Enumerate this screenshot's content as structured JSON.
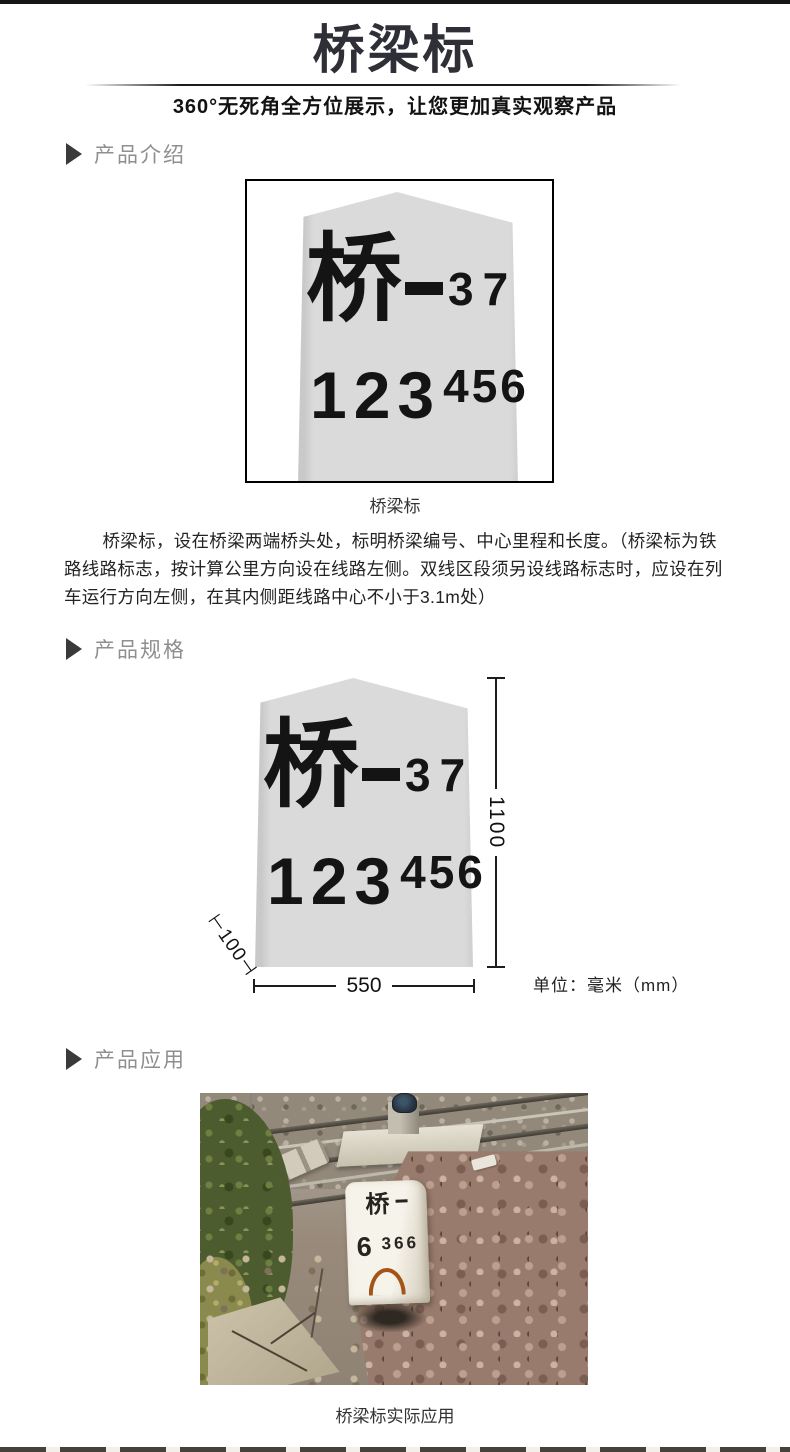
{
  "page": {
    "title": "桥梁标",
    "subtitle": "360°无死角全方位展示，让您更加真实观察产品"
  },
  "sections": {
    "intro_label": "产品介绍",
    "spec_label": "产品规格",
    "application_label": "产品应用"
  },
  "marker": {
    "char": "桥",
    "dash": "—",
    "number_top": "37",
    "number_main": "123",
    "number_sup": "456"
  },
  "figure1": {
    "caption": "桥梁标"
  },
  "intro_text": "桥梁标，设在桥梁两端桥头处，标明桥梁编号、中心里程和长度。（桥梁标为铁路线路标志，按计算公里方向设在线路左侧。双线区段须另设线路标志时，应设在列车运行方向左侧，在其内侧距线路中心不小于3.1m处）",
  "spec": {
    "height_label": "1100",
    "width_label": "550",
    "depth_label": "⊢100⊣",
    "unit_label": "单位：毫米（mm）"
  },
  "photo": {
    "stone_char": "桥",
    "stone_dash": "-",
    "stone_num_main": "6",
    "stone_num_sub": "366",
    "caption": "桥梁标实际应用"
  },
  "colors": {
    "title_text": "#2f2f38",
    "section_label": "#8f8f8f",
    "stone_fill": "#dadada",
    "marker_text": "#141414",
    "rust_mark": "#a45417"
  }
}
